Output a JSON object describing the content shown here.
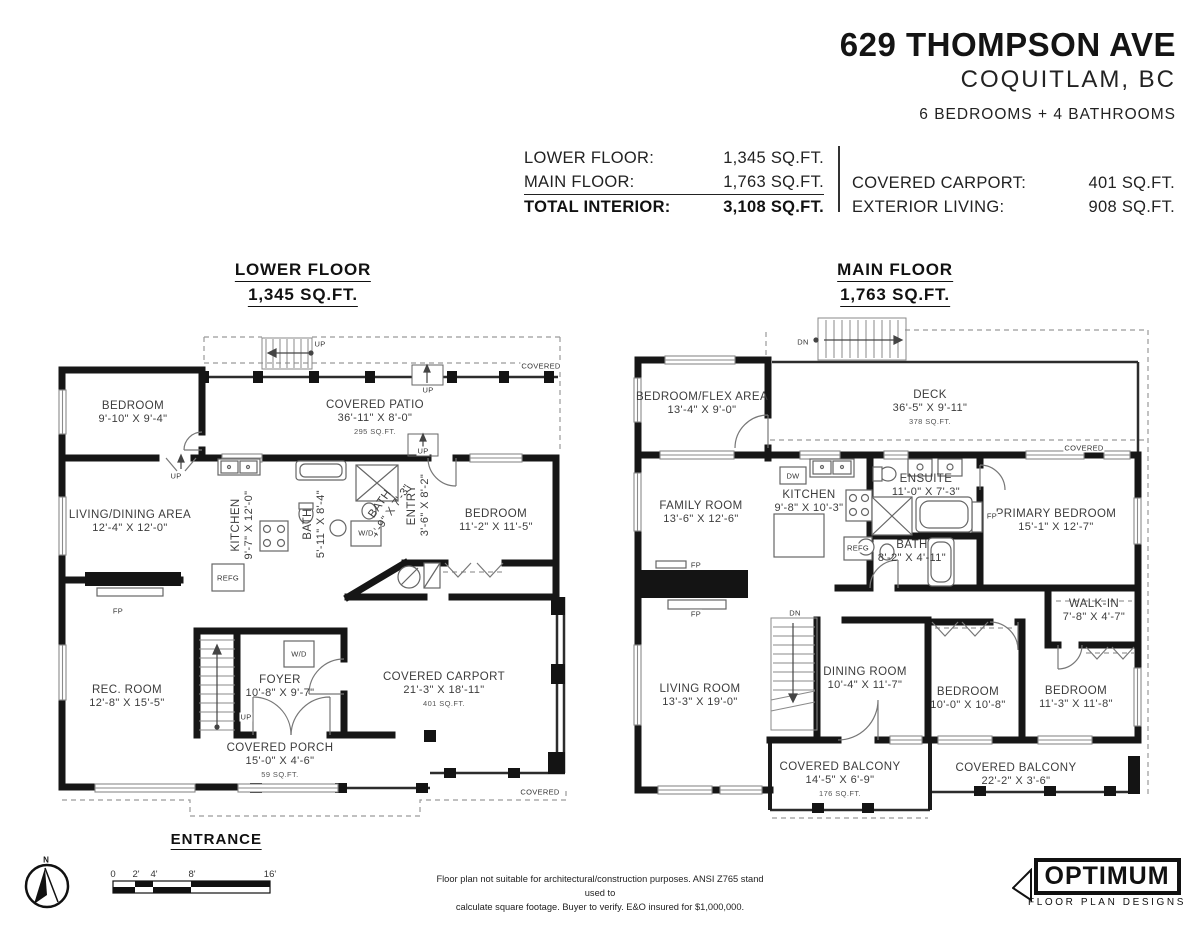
{
  "header": {
    "address": "629 THOMPSON AVE",
    "city": "COQUITLAM, BC",
    "rooms_summary": "6 BEDROOMS + 4 BATHROOMS"
  },
  "areas": {
    "lower_label": "LOWER FLOOR:",
    "lower_value": "1,345 SQ.FT.",
    "main_label": "MAIN FLOOR:",
    "main_value": "1,763 SQ.FT.",
    "total_label": "TOTAL INTERIOR:",
    "total_value": "3,108 SQ.FT.",
    "carport_label": "COVERED CARPORT:",
    "carport_value": "401 SQ.FT.",
    "exterior_label": "EXTERIOR LIVING:",
    "exterior_value": "908 SQ.FT."
  },
  "lower_floor": {
    "title": "LOWER FLOOR",
    "subtitle": "1,345 SQ.FT.",
    "rooms": [
      {
        "name": "BEDROOM",
        "dims": "9'-10\" X 9'-4\""
      },
      {
        "name": "COVERED PATIO",
        "dims": "36'-11\" X 8'-0\"",
        "area": "295 SQ.FT."
      },
      {
        "name": "LIVING/DINING AREA",
        "dims": "12'-4\" X 12'-0\""
      },
      {
        "name": "KITCHEN",
        "dims": "9'-7\" X 12'-0\""
      },
      {
        "name": "BATH",
        "dims": "5'-11\" X 8'-4\""
      },
      {
        "name": "BATH",
        "dims": "4'-9\" X 7'-3\""
      },
      {
        "name": "ENTRY",
        "dims": "3'-6\" X 8'-2\""
      },
      {
        "name": "BEDROOM",
        "dims": "11'-2\" X 11'-5\""
      },
      {
        "name": "REC. ROOM",
        "dims": "12'-8\" X 15'-5\""
      },
      {
        "name": "FOYER",
        "dims": "10'-8\" X 9'-7\""
      },
      {
        "name": "COVERED CARPORT",
        "dims": "21'-3\" X 18'-11\"",
        "area": "401 SQ.FT."
      },
      {
        "name": "COVERED PORCH",
        "dims": "15'-0\" X 4'-6\"",
        "area": "59 SQ.FT."
      }
    ]
  },
  "main_floor": {
    "title": "MAIN FLOOR",
    "subtitle": "1,763 SQ.FT.",
    "rooms": [
      {
        "name": "BEDROOM/FLEX AREA",
        "dims": "13'-4\" X 9'-0\""
      },
      {
        "name": "DECK",
        "dims": "36'-5\" X 9'-11\"",
        "area": "378 SQ.FT."
      },
      {
        "name": "FAMILY ROOM",
        "dims": "13'-6\" X 12'-6\""
      },
      {
        "name": "KITCHEN",
        "dims": "9'-8\" X 10'-3\""
      },
      {
        "name": "ENSUITE",
        "dims": "11'-0\" X 7'-3\""
      },
      {
        "name": "PRIMARY BEDROOM",
        "dims": "15'-1\" X 12'-7\""
      },
      {
        "name": "BATH",
        "dims": "8'-2\" X 4'-11\""
      },
      {
        "name": "WALK-IN",
        "dims": "7'-8\" X 4'-7\""
      },
      {
        "name": "LIVING ROOM",
        "dims": "13'-3\" X 19'-0\""
      },
      {
        "name": "DINING ROOM",
        "dims": "10'-4\" X 11'-7\""
      },
      {
        "name": "BEDROOM",
        "dims": "10'-0\" X 10'-8\""
      },
      {
        "name": "BEDROOM",
        "dims": "11'-3\" X 11'-8\""
      },
      {
        "name": "COVERED BALCONY",
        "dims": "14'-5\" X 6'-9\"",
        "area": "176 SQ.FT."
      },
      {
        "name": "COVERED BALCONY",
        "dims": "22'-2\" X 3'-6\""
      }
    ]
  },
  "annotations": {
    "up": "UP",
    "dn": "DN",
    "wd": "W/D",
    "refg": "REFG",
    "dw": "DW",
    "fp": "FP",
    "covered": "COVERED"
  },
  "entrance_label": "ENTRANCE",
  "compass_label": "N",
  "scale_bar": {
    "ticks": [
      "0",
      "2'",
      "4'",
      "8'",
      "16'"
    ]
  },
  "disclaimer": {
    "line1": "Floor plan not suitable for architectural/construction purposes. ANSI Z765 stand used to",
    "line2": "calculate square footage. Buyer to verify.  E&O insured for $1,000,000."
  },
  "logo": {
    "name": "OPTIMUM",
    "tagline": "FLOOR PLAN DESIGNS"
  },
  "colors": {
    "wall": "#161616",
    "text": "#1d1d1d",
    "room_text": "#3c3c3c"
  }
}
